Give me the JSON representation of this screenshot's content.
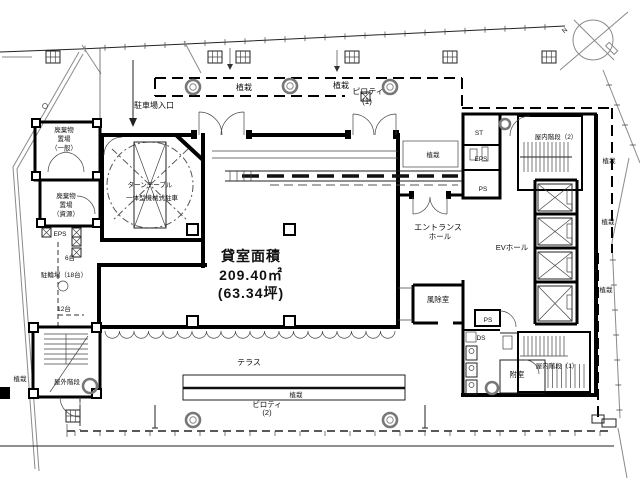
{
  "drawing": {
    "rental_area": {
      "title": "貸室面積",
      "m2": "209.40㎡",
      "tsubo": "(63.34坪)"
    },
    "labels": {
      "planting": "植栽",
      "parking_entrance": "駐車場入口",
      "turntable_l1": "ターンテーブル",
      "turntable_l2": "一体型機械式駐車",
      "waste": "廃棄物",
      "storage": "置場",
      "general": "（一般）",
      "recycle": "（資源）",
      "eps": "EPS",
      "ps": "PS",
      "ds": "DS",
      "st": "ST",
      "bike_capacity": "駐輪場（18台）",
      "bike_6": "6台",
      "bike_12": "12台",
      "outdoor_stair": "屋外階段",
      "indoor_stair1": "屋内階段（1）",
      "indoor_stair2": "屋内階段（2）",
      "entrance_l1": "エントランス",
      "entrance_l2": "ホール",
      "ev_hall": "EVホール",
      "windbreak": "風除室",
      "vestibule": "附室",
      "terrace": "テラス",
      "piloti": "ピロティ",
      "no1": "(1)",
      "no2": "(2)",
      "north": "N"
    }
  }
}
